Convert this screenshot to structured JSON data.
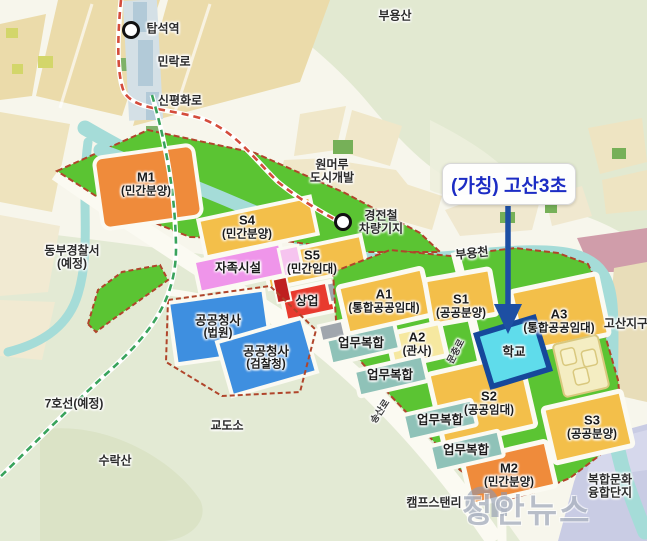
{
  "annotation": {
    "school_callout": "(가칭) 고산3초"
  },
  "watermark": {
    "brand": "정안뉴스",
    "logo": "jn-monogram"
  },
  "zones": {
    "m1": {
      "code": "M1",
      "type": "(민간분양)"
    },
    "s4": {
      "code": "S4",
      "type": "(민간분양)"
    },
    "s5": {
      "code": "S5",
      "type": "(민간임대)"
    },
    "jajok": {
      "name": "자족시설"
    },
    "sangeop": {
      "name": "상업"
    },
    "court": {
      "name": "공공청사",
      "type": "(법원)"
    },
    "prosecution": {
      "name": "공공청사",
      "type": "(검찰청)"
    },
    "a1": {
      "code": "A1",
      "type": "(통합공공임대)"
    },
    "s1": {
      "code": "S1",
      "type": "(공공분양)"
    },
    "a2": {
      "code": "A2",
      "type": "(관사)"
    },
    "a3": {
      "code": "A3",
      "type": "(통합공공임대)"
    },
    "school": {
      "name": "학교"
    },
    "s2": {
      "code": "S2",
      "type": "(공공임대)"
    },
    "s3": {
      "code": "S3",
      "type": "(공공분양)"
    },
    "m2": {
      "code": "M2",
      "type": "(민간분양)"
    },
    "biz": {
      "name": "업무복합"
    },
    "culture": {
      "line1": "복합문화",
      "line2": "융합단지"
    }
  },
  "places": {
    "buyongsan": "부용산",
    "tapseok_station": "탑석역",
    "minrak_ro": "민락로",
    "sinpyeonghwa_ro": "신평화로",
    "wonmeoru_line1": "원머루",
    "wonmeoru_line2": "도시개발",
    "lrt_depot_line1": "경전철",
    "lrt_depot_line2": "차량기지",
    "buyongcheon": "부용천",
    "dongbu_line1": "동부경찰서",
    "dongbu_line2": "(예정)",
    "line7": "7호선(예정)",
    "prison": "교도소",
    "suraksan": "수락산",
    "camp_stanley": "캠프스탠리",
    "gosan_district": "고산지구",
    "muchung_ro": "문충로",
    "songsan_ro": "송산로"
  },
  "colors": {
    "residential_yellow": "#f3bf4a",
    "private_orange": "#ef8b3b",
    "greenbelt": "#5bc433",
    "business_teal": "#8fc2b8",
    "public_blue": "#3e8fe0",
    "commercial_red": "#e83a2e",
    "selfsufficient_pink": "#ef95ea",
    "school_cyan": "#5fdceb",
    "school_border": "#16489a",
    "river": "#a5dcd8",
    "boundary_dash": "#b0452b",
    "rail_dash": "#d44c3c",
    "line7_dash": "#39a35c",
    "callout_blue": "#1c2cc4"
  }
}
